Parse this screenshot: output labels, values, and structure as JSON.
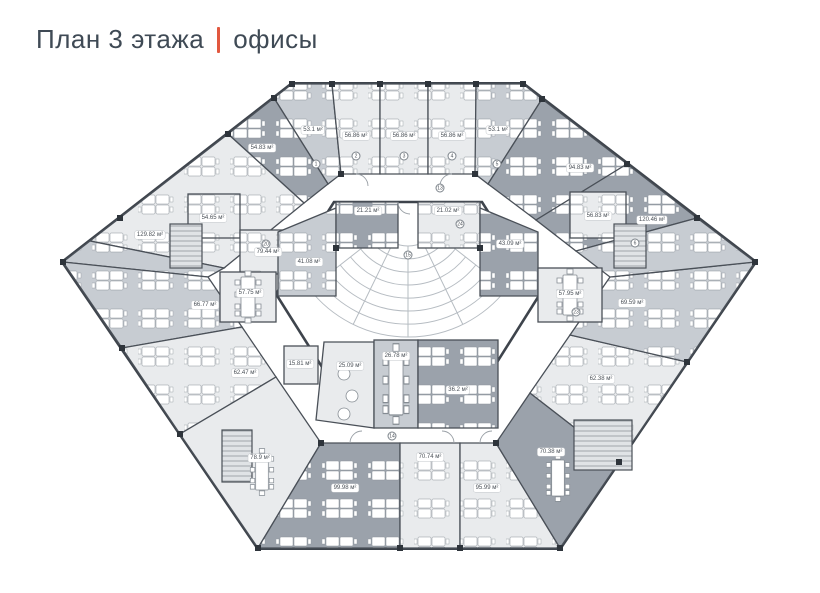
{
  "header": {
    "title": "План 3 этажа",
    "subtitle": "офисы",
    "accent_color": "#e2583f",
    "text_color": "#3f4a55"
  },
  "plan": {
    "unit_suffix": "м²",
    "wall_color": "#3e444c",
    "room_fills": {
      "light": "#e9ebed",
      "medium": "#c7ccd2",
      "dark": "#9ba2ab"
    },
    "rooms": [
      {
        "id": "top-left-corner",
        "label": "53.1 м²",
        "x": 313,
        "y": 130
      },
      {
        "id": "top-office-1",
        "label": "56.86 м²",
        "x": 356,
        "y": 136
      },
      {
        "id": "top-office-2",
        "label": "56.86 м²",
        "x": 404,
        "y": 136
      },
      {
        "id": "top-office-3",
        "label": "56.86 м²",
        "x": 452,
        "y": 136
      },
      {
        "id": "top-right-corner",
        "label": "53.1 м²",
        "x": 498,
        "y": 130
      },
      {
        "id": "upper-left-office-1",
        "label": "54.83 м²",
        "x": 262,
        "y": 148
      },
      {
        "id": "upper-left-open-office",
        "label": "129.82 м²",
        "x": 150,
        "y": 235
      },
      {
        "id": "upper-left-office-2",
        "label": "54.65 м²",
        "x": 213,
        "y": 218
      },
      {
        "id": "upper-left-office-3",
        "label": "79.44 м²",
        "x": 268,
        "y": 252
      },
      {
        "id": "left-meeting-room",
        "label": "57.75 м²",
        "x": 250,
        "y": 293
      },
      {
        "id": "left-mid-office",
        "label": "41.08 м²",
        "x": 309,
        "y": 262
      },
      {
        "id": "lower-left-office-1",
        "label": "66.77 м²",
        "x": 205,
        "y": 305
      },
      {
        "id": "lower-left-office-2",
        "label": "62.47 м²",
        "x": 245,
        "y": 373
      },
      {
        "id": "small-office",
        "label": "15.81 м²",
        "x": 300,
        "y": 364
      },
      {
        "id": "lower-left-corner",
        "label": "78.9 м²",
        "x": 260,
        "y": 458
      },
      {
        "id": "bottom-office-1",
        "label": "99.98 м²",
        "x": 345,
        "y": 488
      },
      {
        "id": "bottom-office-2",
        "label": "70.74 м²",
        "x": 430,
        "y": 457
      },
      {
        "id": "bottom-office-3",
        "label": "95.99 м²",
        "x": 487,
        "y": 488
      },
      {
        "id": "lower-right-corner",
        "label": "70.38 м²",
        "x": 551,
        "y": 452
      },
      {
        "id": "lower-right-office-1",
        "label": "62.38 м²",
        "x": 601,
        "y": 379
      },
      {
        "id": "lower-right-office-2",
        "label": "69.59 м²",
        "x": 632,
        "y": 303
      },
      {
        "id": "upper-right-open-office",
        "label": "120.46 м²",
        "x": 652,
        "y": 220
      },
      {
        "id": "upper-right-office-1",
        "label": "94.83 м²",
        "x": 580,
        "y": 168
      },
      {
        "id": "upper-right-office-2",
        "label": "56.83 м²",
        "x": 598,
        "y": 216
      },
      {
        "id": "right-meeting-room",
        "label": "57.95 м²",
        "x": 570,
        "y": 294
      },
      {
        "id": "right-mid-office",
        "label": "43.09 м²",
        "x": 510,
        "y": 244
      },
      {
        "id": "center-top-left-office",
        "label": "21.21 м²",
        "x": 368,
        "y": 211
      },
      {
        "id": "center-top-right-office",
        "label": "21.02 м²",
        "x": 448,
        "y": 211
      },
      {
        "id": "center-bottom-left-room",
        "label": "25.09 м²",
        "x": 350,
        "y": 366
      },
      {
        "id": "center-bottom-meeting",
        "label": "26.78 м²",
        "x": 396,
        "y": 356
      },
      {
        "id": "center-bottom-right-office",
        "label": "36.2 м²",
        "x": 458,
        "y": 390
      }
    ],
    "markers": [
      {
        "n": "1",
        "x": 316,
        "y": 164
      },
      {
        "n": "2",
        "x": 356,
        "y": 156
      },
      {
        "n": "3",
        "x": 404,
        "y": 156
      },
      {
        "n": "4",
        "x": 452,
        "y": 156
      },
      {
        "n": "5",
        "x": 497,
        "y": 164
      },
      {
        "n": "13",
        "x": 440,
        "y": 188
      },
      {
        "n": "15",
        "x": 408,
        "y": 255
      },
      {
        "n": "20",
        "x": 266,
        "y": 244
      },
      {
        "n": "24",
        "x": 460,
        "y": 224
      },
      {
        "n": "23",
        "x": 576,
        "y": 312
      },
      {
        "n": "6",
        "x": 635,
        "y": 243
      },
      {
        "n": "14",
        "x": 392,
        "y": 436
      }
    ]
  }
}
